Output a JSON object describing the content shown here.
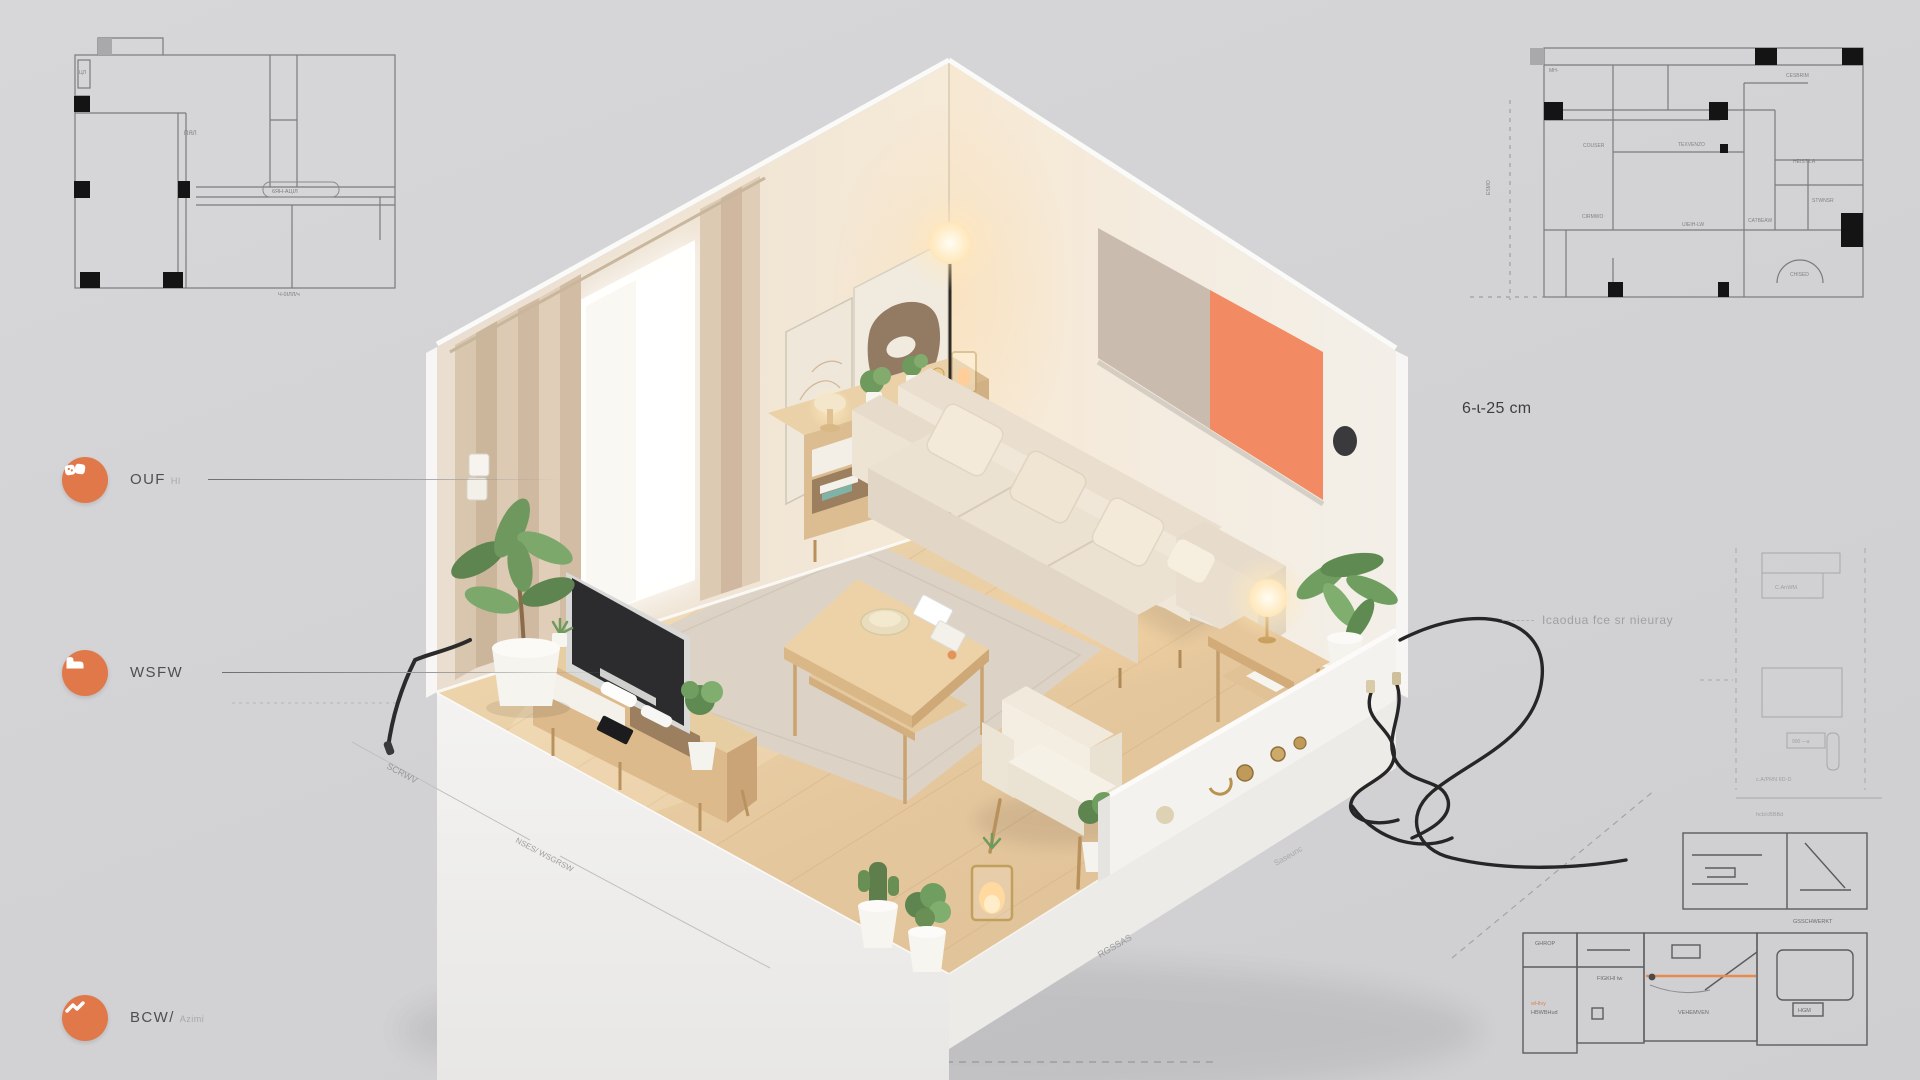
{
  "callouts": [
    {
      "label": "OUF",
      "suffix": "HI",
      "icon": "binoculars-icon"
    },
    {
      "label": "WSFW",
      "suffix": "",
      "icon": "sofa-icon"
    },
    {
      "label": "BCW/",
      "suffix": "Azimi",
      "icon": "wave-icon"
    }
  ],
  "notes": {
    "dimension_note": "6-ɩ-25 cm",
    "faint_note": "Icaodua fce sr nieuray"
  },
  "plan_top_left": {
    "labels": {
      "side": "ЦЛ",
      "room": "ПЯЛ",
      "pill": "6ЯН-АЦІЛ",
      "bottom": "Ч-0ІЛЛ/ч"
    }
  },
  "plan_top_right": {
    "labels": {
      "l1": "MH-",
      "l2": "CESBRIM",
      "l3": "COUSER",
      "l4": "TEXVENZO",
      "l5": "HEISTILA",
      "l6": "STWNSR",
      "l7": "CIRMWO",
      "l8": "UIEIH-LW",
      "l9": "CATBEAW",
      "l10": "CHISED",
      "side": "ESMO"
    }
  },
  "plan_right_faint": {
    "labels": {
      "top": "C.AnWM.",
      "mid": "900 —a",
      "row": "c.A/PRN IID-D",
      "bottom": "hcb/cBBBd"
    }
  },
  "plan_bottom_right": {
    "labels": {
      "caption": "GSSCHWERKT",
      "b1": "GHROP",
      "b1_orange": "wHtvy",
      "b1_sub": "HBWBHud",
      "b2": "FIGKHI tw",
      "b3": "VEHEMVEN",
      "b4": "HGM"
    }
  },
  "floor_annotations": {
    "a1": "SCRWV",
    "a2": "NSES/ WSGRSW",
    "a3": "RGSSAS",
    "a4": "Saseunc"
  },
  "colors": {
    "accent_orange": "#E0784A",
    "coral_panel": "#F28B63",
    "taupe_panel": "#C9BCAE",
    "wood": "#DDBE92",
    "cream_sofa": "#EDE4D6",
    "background": "#D3D3D5"
  }
}
